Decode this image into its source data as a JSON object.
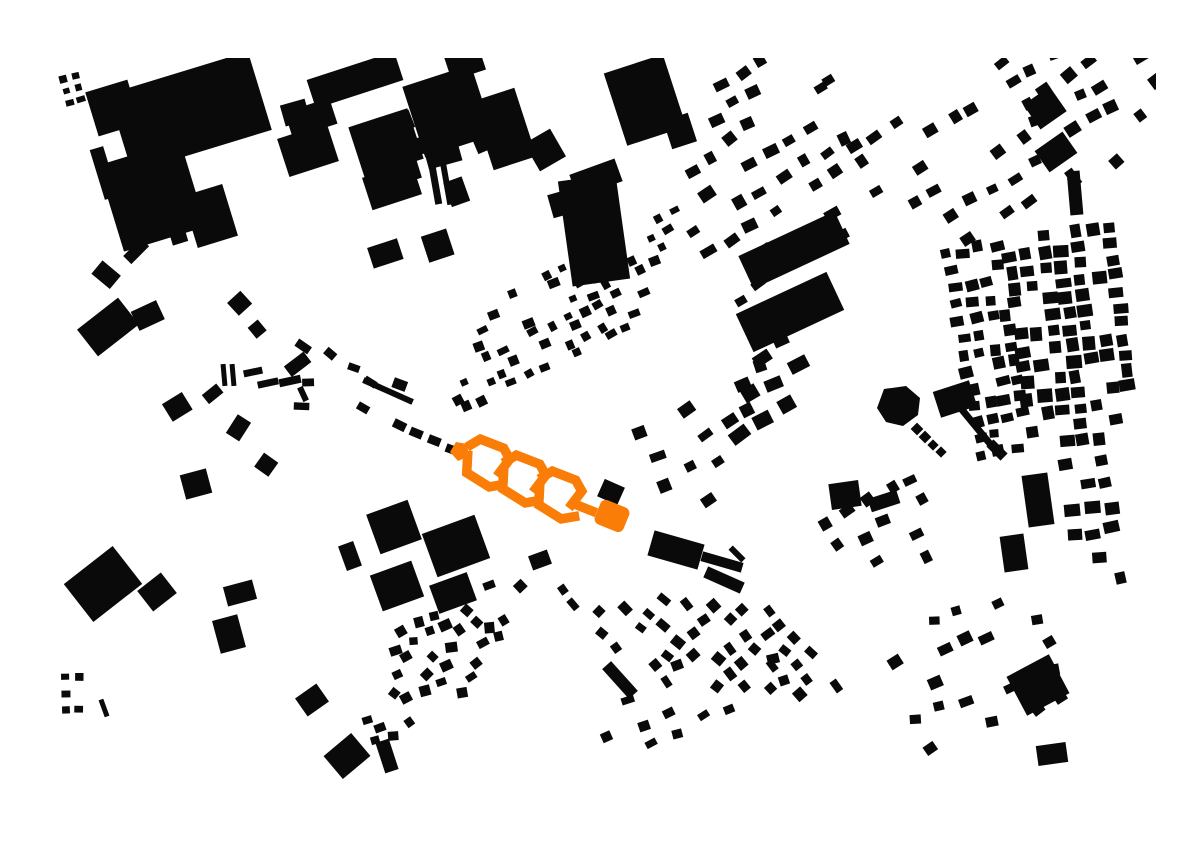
{
  "canvas": {
    "width": 1191,
    "height": 842,
    "background_color": "#ffffff",
    "building_color": "#0a0a0a",
    "highlight_color": "#f97d06"
  },
  "map": {
    "explicit_buildings": [
      [
        113,
        108,
        44,
        46,
        -17
      ],
      [
        190,
        112,
        146,
        82,
        -17
      ],
      [
        152,
        196,
        86,
        90,
        -17
      ],
      [
        104,
        173,
        14,
        52,
        -17
      ],
      [
        210,
        216,
        42,
        54,
        -17
      ],
      [
        150,
        236,
        20,
        13,
        -17
      ],
      [
        179,
        238,
        16,
        11,
        -17
      ],
      [
        355,
        80,
        92,
        30,
        -18
      ],
      [
        311,
        118,
        47,
        27,
        -18
      ],
      [
        308,
        150,
        52,
        40,
        -18
      ],
      [
        448,
        111,
        72,
        74,
        -18
      ],
      [
        504,
        129,
        45,
        72,
        -18
      ],
      [
        545,
        150,
        30,
        32,
        -30
      ],
      [
        386,
        143,
        62,
        53,
        -18
      ],
      [
        420,
        146,
        15,
        17,
        -18
      ],
      [
        434,
        177,
        7,
        55,
        -10
      ],
      [
        446,
        180,
        6,
        50,
        -10
      ],
      [
        392,
        186,
        52,
        34,
        -18
      ],
      [
        645,
        100,
        62,
        76,
        -18
      ],
      [
        680,
        131,
        26,
        30,
        -18
      ],
      [
        594,
        230,
        58,
        106,
        -8
      ],
      [
        596,
        178,
        48,
        24,
        -20
      ],
      [
        794,
        250,
        106,
        36,
        -25
      ],
      [
        790,
        312,
        100,
        42,
        -25
      ],
      [
        1045,
        108,
        32,
        30,
        -35
      ],
      [
        1056,
        152,
        34,
        26,
        -35
      ],
      [
        1075,
        193,
        13,
        44,
        -5
      ],
      [
        845,
        495,
        30,
        26,
        -8
      ],
      [
        884,
        501,
        30,
        14,
        -18
      ],
      [
        1014,
        553,
        24,
        36,
        -8
      ],
      [
        1038,
        500,
        26,
        52,
        -8
      ],
      [
        676,
        550,
        52,
        26,
        16
      ],
      [
        722,
        562,
        42,
        10,
        16
      ],
      [
        737,
        554,
        18,
        6,
        45
      ],
      [
        611,
        492,
        22,
        19,
        24
      ],
      [
        388,
        391,
        54,
        6,
        24
      ],
      [
        394,
        527,
        44,
        42,
        -20
      ],
      [
        456,
        546,
        56,
        46,
        -20
      ],
      [
        350,
        556,
        16,
        26,
        -20
      ],
      [
        397,
        586,
        44,
        38,
        -20
      ],
      [
        453,
        593,
        40,
        30,
        -20
      ],
      [
        540,
        560,
        20,
        15,
        -20
      ],
      [
        108,
        327,
        52,
        34,
        -38
      ],
      [
        103,
        584,
        62,
        48,
        -38
      ],
      [
        196,
        484,
        27,
        25,
        -15
      ],
      [
        157,
        592,
        30,
        26,
        -38
      ],
      [
        240,
        593,
        30,
        20,
        -15
      ],
      [
        229,
        634,
        26,
        34,
        -15
      ],
      [
        312,
        700,
        26,
        22,
        -35
      ],
      [
        224,
        375,
        5,
        22,
        -5
      ],
      [
        233,
        375,
        5,
        22,
        -5
      ],
      [
        253,
        372,
        19,
        7,
        -12
      ],
      [
        268,
        383,
        21,
        7,
        -12
      ],
      [
        290,
        381,
        22,
        8,
        -12
      ],
      [
        303,
        394,
        15,
        6,
        65
      ],
      [
        104,
        708,
        5,
        18,
        -20
      ],
      [
        347,
        756,
        36,
        30,
        -40
      ],
      [
        387,
        756,
        14,
        32,
        -18
      ],
      [
        1038,
        685,
        48,
        44,
        -28
      ],
      [
        1052,
        754,
        30,
        20,
        -8
      ],
      [
        620,
        680,
        40,
        12,
        48
      ],
      [
        724,
        580,
        40,
        12,
        24
      ]
    ],
    "clusters": [
      {
        "x": 63,
        "y": 79,
        "au": -15,
        "nu": 2,
        "nv": 3,
        "su": 13,
        "sv": 12,
        "w": [
          6,
          9
        ],
        "h": [
          5,
          8
        ],
        "d": 0.9,
        "jit": 1,
        "aj": 3,
        "seed": 11
      },
      {
        "x": 296,
        "y": 116,
        "au": -19,
        "nu": 6,
        "nv": 5,
        "su": 44,
        "sv": 41,
        "w": [
          18,
          38
        ],
        "h": [
          14,
          30
        ],
        "d": 0.55,
        "jit": 8,
        "aj": 4,
        "seed": 21
      },
      {
        "x": 668,
        "y": 182,
        "au": -31,
        "av": 59,
        "nu": 8,
        "nv": 6,
        "su": 25,
        "sv": 27,
        "w": [
          9,
          16
        ],
        "h": [
          8,
          13
        ],
        "d": 0.6,
        "jit": 4,
        "aj": 6,
        "seed": 31
      },
      {
        "x": 852,
        "y": 148,
        "au": -31,
        "av": 59,
        "nu": 8,
        "nv": 6,
        "su": 25,
        "sv": 27,
        "w": [
          9,
          15
        ],
        "h": [
          8,
          12
        ],
        "d": 0.6,
        "jit": 4,
        "aj": 6,
        "seed": 32
      },
      {
        "x": 700,
        "y": 95,
        "au": -31,
        "av": 59,
        "nu": 7,
        "nv": 3,
        "su": 24,
        "sv": 26,
        "w": [
          9,
          15
        ],
        "h": [
          8,
          12
        ],
        "d": 0.55,
        "jit": 4,
        "aj": 8,
        "seed": 33
      },
      {
        "x": 1008,
        "y": 240,
        "au": -7,
        "nu": 7,
        "nv": 14,
        "su": 17,
        "sv": 16,
        "w": [
          10,
          16
        ],
        "h": [
          9,
          14
        ],
        "d": 0.8,
        "jit": 2,
        "aj": 4,
        "seed": 41
      },
      {
        "x": 948,
        "y": 254,
        "au": -10,
        "nu": 4,
        "nv": 13,
        "su": 16,
        "sv": 17,
        "w": [
          9,
          14
        ],
        "h": [
          8,
          12
        ],
        "d": 0.68,
        "jit": 3,
        "aj": 6,
        "seed": 51
      },
      {
        "x": 1000,
        "y": 60,
        "au": -31,
        "nu": 6,
        "nv": 7,
        "su": 24,
        "sv": 24,
        "w": [
          9,
          15
        ],
        "h": [
          8,
          13
        ],
        "d": 0.6,
        "jit": 4,
        "aj": 12,
        "seed": 61
      },
      {
        "x": 449,
        "y": 415,
        "au": -26,
        "av": -67,
        "nu": 12,
        "nv": 8,
        "su": 18,
        "sv": 18,
        "w": [
          7,
          12
        ],
        "h": [
          6,
          10
        ],
        "d": 0.6,
        "jit": 3,
        "aj": 6,
        "seed": 71
      },
      {
        "x": 712,
        "y": 384,
        "au": -30,
        "nu": 4,
        "nv": 3,
        "su": 27,
        "sv": 28,
        "w": [
          14,
          20
        ],
        "h": [
          11,
          16
        ],
        "d": 0.7,
        "jit": 4,
        "aj": 8,
        "seed": 81
      },
      {
        "x": 82,
        "y": 304,
        "au": -40,
        "av": 50,
        "nu": 4,
        "nv": 6,
        "su": 42,
        "sv": 46,
        "w": [
          13,
          28
        ],
        "h": [
          11,
          24
        ],
        "d": 0.5,
        "jit": 12,
        "aj": 18,
        "seed": 91
      },
      {
        "x": 300,
        "y": 346,
        "au": 24,
        "av": 114,
        "nu": 5,
        "nv": 3,
        "su": 27,
        "sv": 26,
        "w": [
          11,
          18
        ],
        "h": [
          7,
          11
        ],
        "d": 0.6,
        "jit": 6,
        "aj": 28,
        "seed": 101
      },
      {
        "x": 399,
        "y": 426,
        "au": 24,
        "av": 114,
        "nu": 4,
        "nv": 1,
        "su": 19,
        "sv": 18,
        "w": [
          12,
          14
        ],
        "h": [
          8,
          9
        ],
        "d": 1,
        "jit": 1,
        "aj": 4,
        "seed": 111
      },
      {
        "x": 357,
        "y": 752,
        "au": -28,
        "av": -70,
        "nu": 8,
        "nv": 8,
        "su": 20,
        "sv": 18,
        "w": [
          8,
          13
        ],
        "h": [
          7,
          11
        ],
        "d": 0.6,
        "jit": 3,
        "aj": 26,
        "seed": 121
      },
      {
        "x": 560,
        "y": 592,
        "au": 47,
        "av": 5,
        "nu": 7,
        "nv": 9,
        "su": 20,
        "sv": 26,
        "w": [
          9,
          13
        ],
        "h": [
          7,
          11
        ],
        "d": 0.55,
        "jit": 3,
        "aj": 10,
        "seed": 131
      },
      {
        "x": 890,
        "y": 640,
        "au": -20,
        "av": 70,
        "nu": 7,
        "nv": 5,
        "su": 24,
        "sv": 28,
        "w": [
          9,
          15
        ],
        "h": [
          8,
          12
        ],
        "d": 0.5,
        "jit": 5,
        "aj": 18,
        "seed": 141
      },
      {
        "x": 828,
        "y": 526,
        "au": -30,
        "nu": 5,
        "nv": 4,
        "su": 24,
        "sv": 26,
        "w": [
          9,
          14
        ],
        "h": [
          8,
          12
        ],
        "d": 0.55,
        "jit": 4,
        "aj": 10,
        "seed": 151
      },
      {
        "x": 642,
        "y": 430,
        "au": -27,
        "nu": 7,
        "nv": 4,
        "su": 27,
        "sv": 30,
        "w": [
          10,
          16
        ],
        "h": [
          8,
          13
        ],
        "d": 0.45,
        "jit": 5,
        "aj": 10,
        "seed": 161
      },
      {
        "x": 600,
        "y": 708,
        "au": -25,
        "nu": 7,
        "nv": 3,
        "su": 30,
        "sv": 28,
        "w": [
          8,
          13
        ],
        "h": [
          7,
          10
        ],
        "d": 0.45,
        "jit": 6,
        "aj": 12,
        "seed": 171
      },
      {
        "x": 65,
        "y": 676,
        "au": 0,
        "nu": 2,
        "nv": 3,
        "su": 14,
        "sv": 17,
        "w": [
          7,
          9
        ],
        "h": [
          6,
          8
        ],
        "d": 0.85,
        "jit": 1,
        "aj": 3,
        "seed": 181
      },
      {
        "x": 1064,
        "y": 464,
        "au": -8,
        "nu": 3,
        "nv": 6,
        "su": 20,
        "sv": 24,
        "w": [
          10,
          16
        ],
        "h": [
          9,
          13
        ],
        "d": 0.65,
        "jit": 3,
        "aj": 5,
        "seed": 191
      }
    ],
    "landmarks": {
      "star_blob": [
        [
          884,
          389
        ],
        [
          906,
          386
        ],
        [
          920,
          398
        ],
        [
          918,
          415
        ],
        [
          903,
          426
        ],
        [
          886,
          422
        ],
        [
          877,
          408
        ]
      ],
      "star_chain": [
        [
          917,
          429,
          9
        ],
        [
          925,
          437,
          9
        ],
        [
          933,
          445,
          8
        ],
        [
          941,
          452,
          8
        ]
      ],
      "ramp_block": [
        955,
        399,
        38,
        27,
        -18
      ],
      "ramp_line": [
        963,
        411,
        991,
        445,
        7
      ],
      "ramp_head": [
        997,
        450,
        20,
        10,
        45
      ]
    },
    "highlight": {
      "pentagon": [
        [
          450,
          452
        ],
        [
          456,
          442
        ],
        [
          467,
          444
        ],
        [
          469,
          456
        ],
        [
          458,
          461
        ]
      ],
      "motifs": {
        "anchors": [
          [
            474,
            435
          ],
          [
            510,
            451
          ],
          [
            546,
            467
          ]
        ],
        "angle": 24,
        "scale": 1.25,
        "upper_path": [
          [
            1,
            8
          ],
          [
            6,
            1
          ],
          [
            26,
            0
          ],
          [
            34,
            6
          ],
          [
            31,
            19
          ]
        ],
        "lower_path": [
          [
            2,
            17
          ],
          [
            7,
            30
          ],
          [
            28,
            33
          ],
          [
            37,
            27
          ]
        ],
        "stroke_width": 9.5
      },
      "end_bar": [
        577,
        505,
        592,
        511,
        9.5
      ],
      "rounded_square": {
        "cx": 612,
        "cy": 516,
        "w": 31,
        "h": 26,
        "angle": 22,
        "rx": 6
      }
    }
  }
}
